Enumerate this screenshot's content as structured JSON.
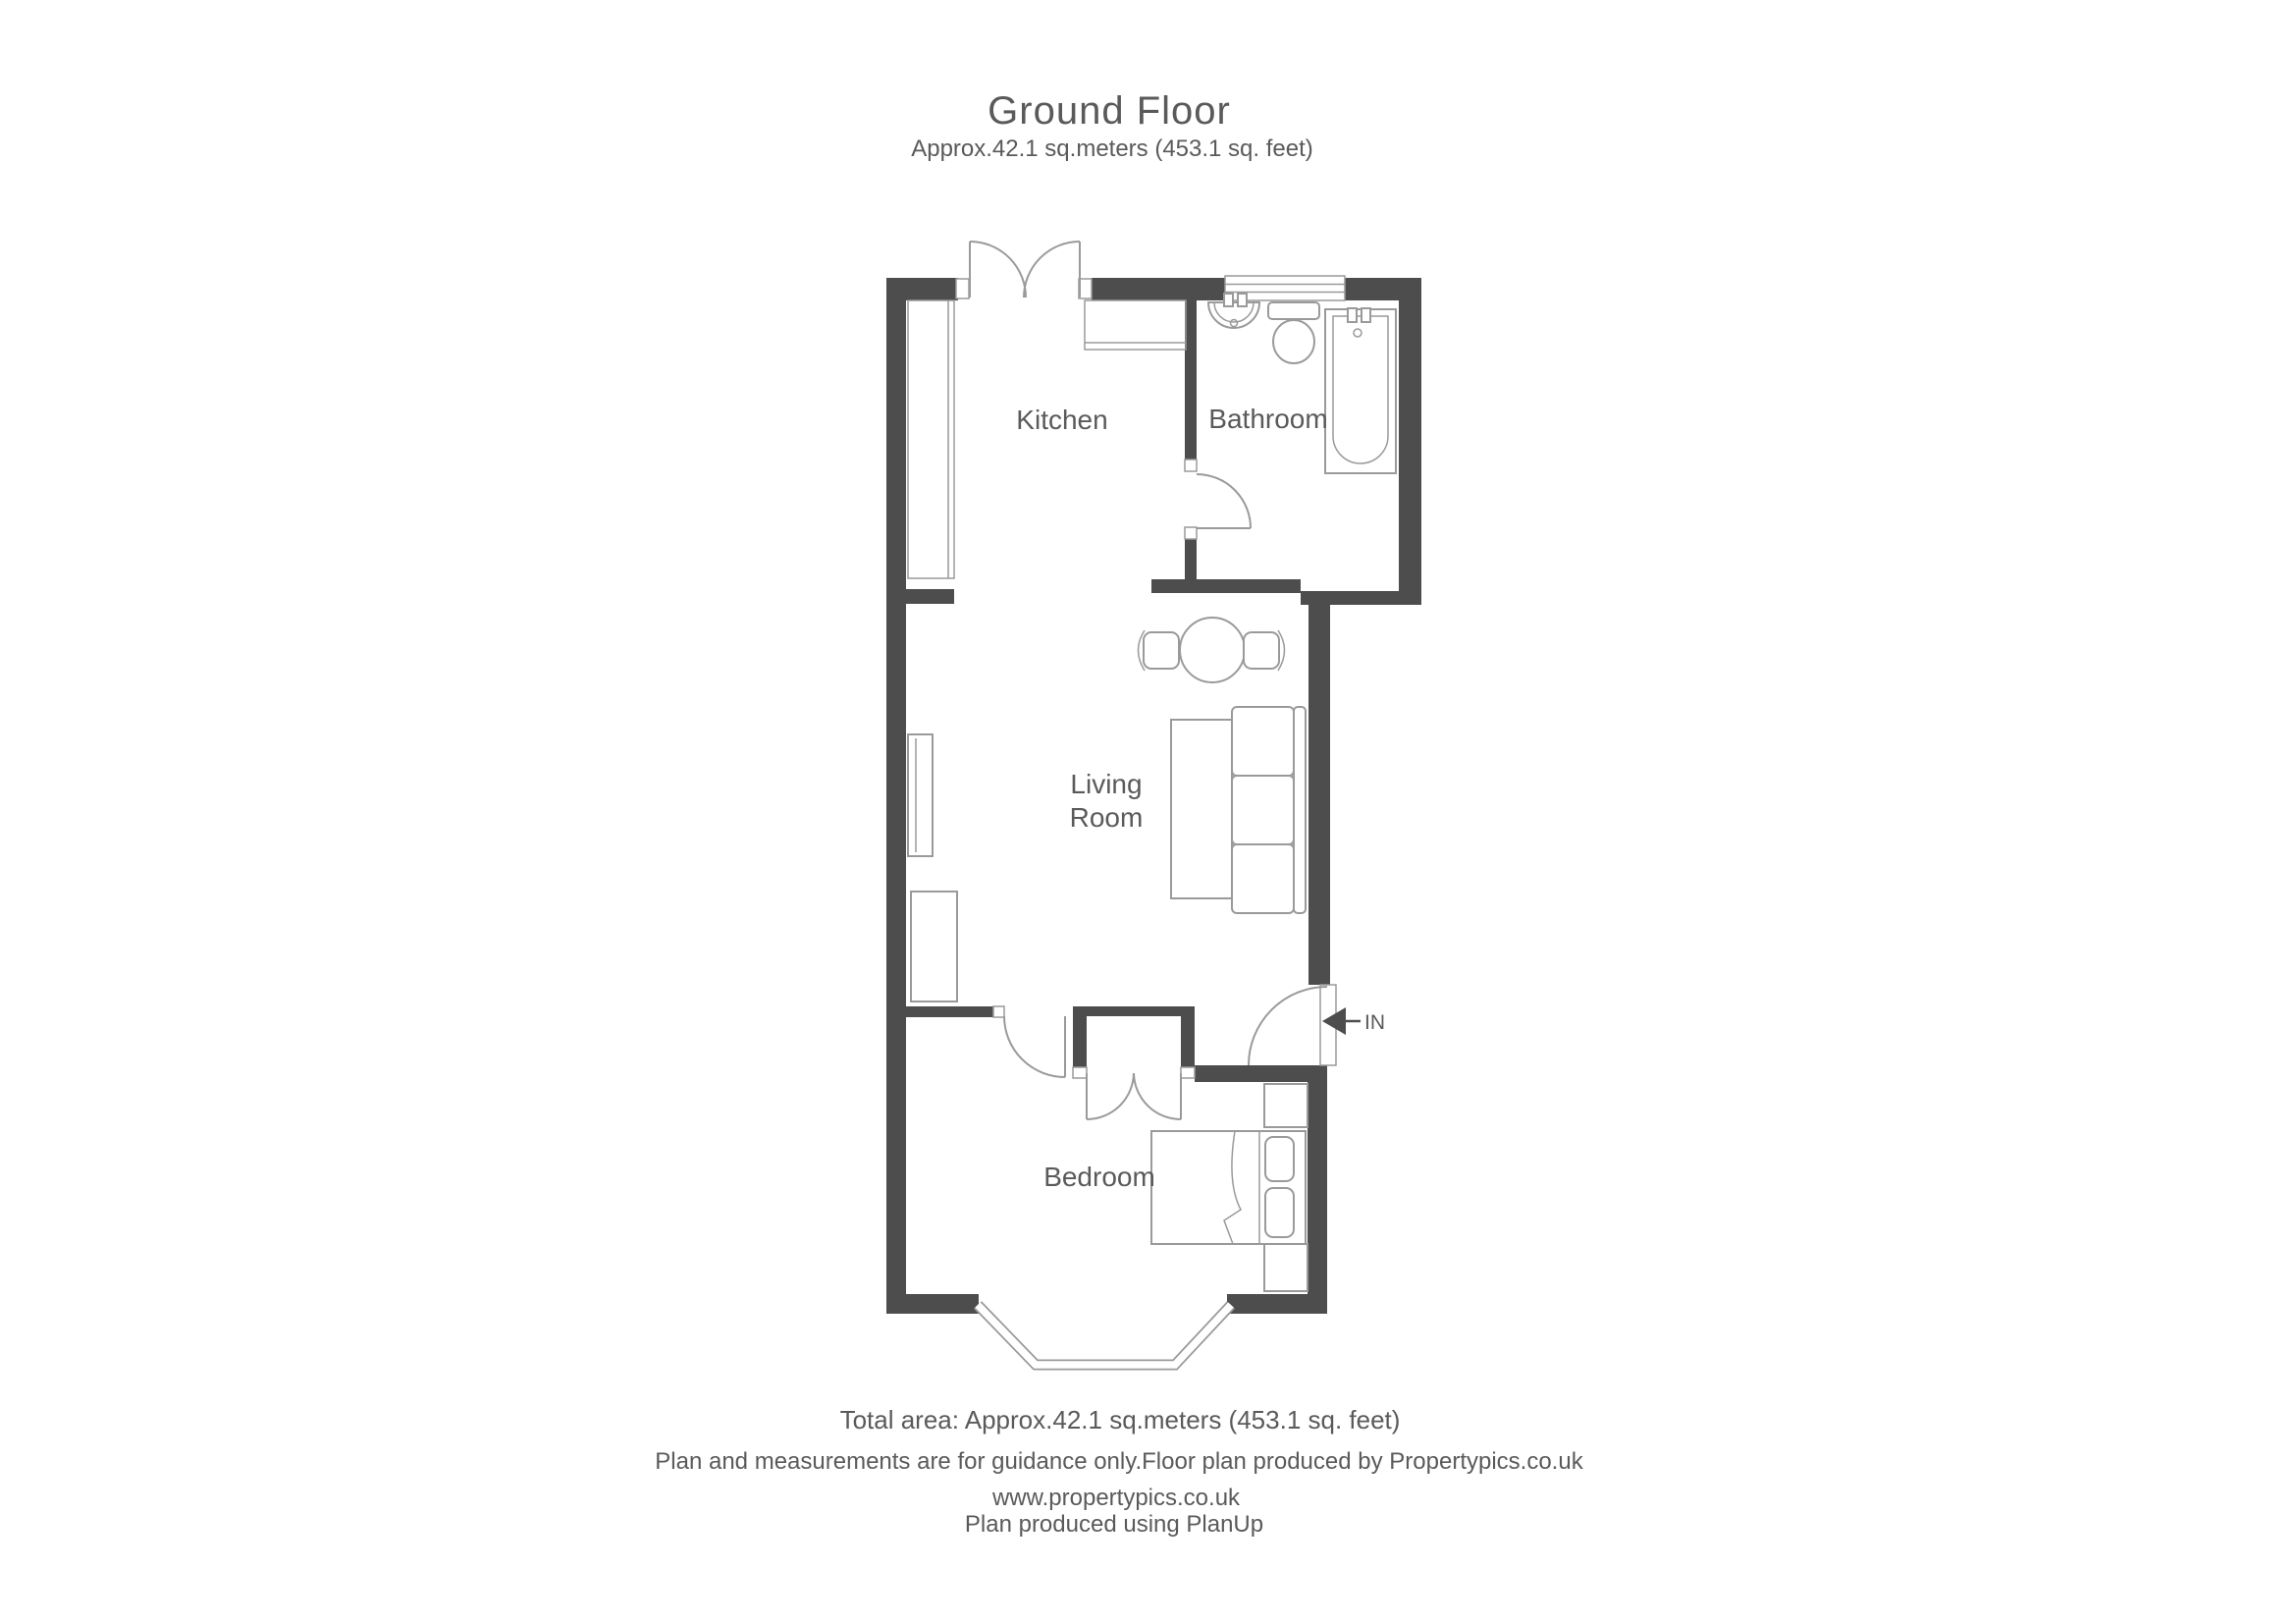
{
  "header": {
    "title": "Ground Floor",
    "subtitle": "Approx.42.1 sq.meters (453.1 sq. feet)"
  },
  "rooms": {
    "kitchen": "Kitchen",
    "bathroom": "Bathroom",
    "living_line1": "Living",
    "living_line2": "Room",
    "bedroom": "Bedroom"
  },
  "entrance": {
    "label": "IN"
  },
  "footer": {
    "total_area": "Total area: Approx.42.1 sq.meters (453.1 sq. feet)",
    "disclaimer": "Plan and measurements are for guidance only.Floor plan produced by Propertypics.co.uk",
    "website": "www.propertypics.co.uk",
    "produced_with": "Plan produced using PlanUp"
  },
  "colors": {
    "wall": "#4d4d4d",
    "line": "#9a9a9a",
    "text": "#5a5a5a",
    "background": "#ffffff"
  }
}
